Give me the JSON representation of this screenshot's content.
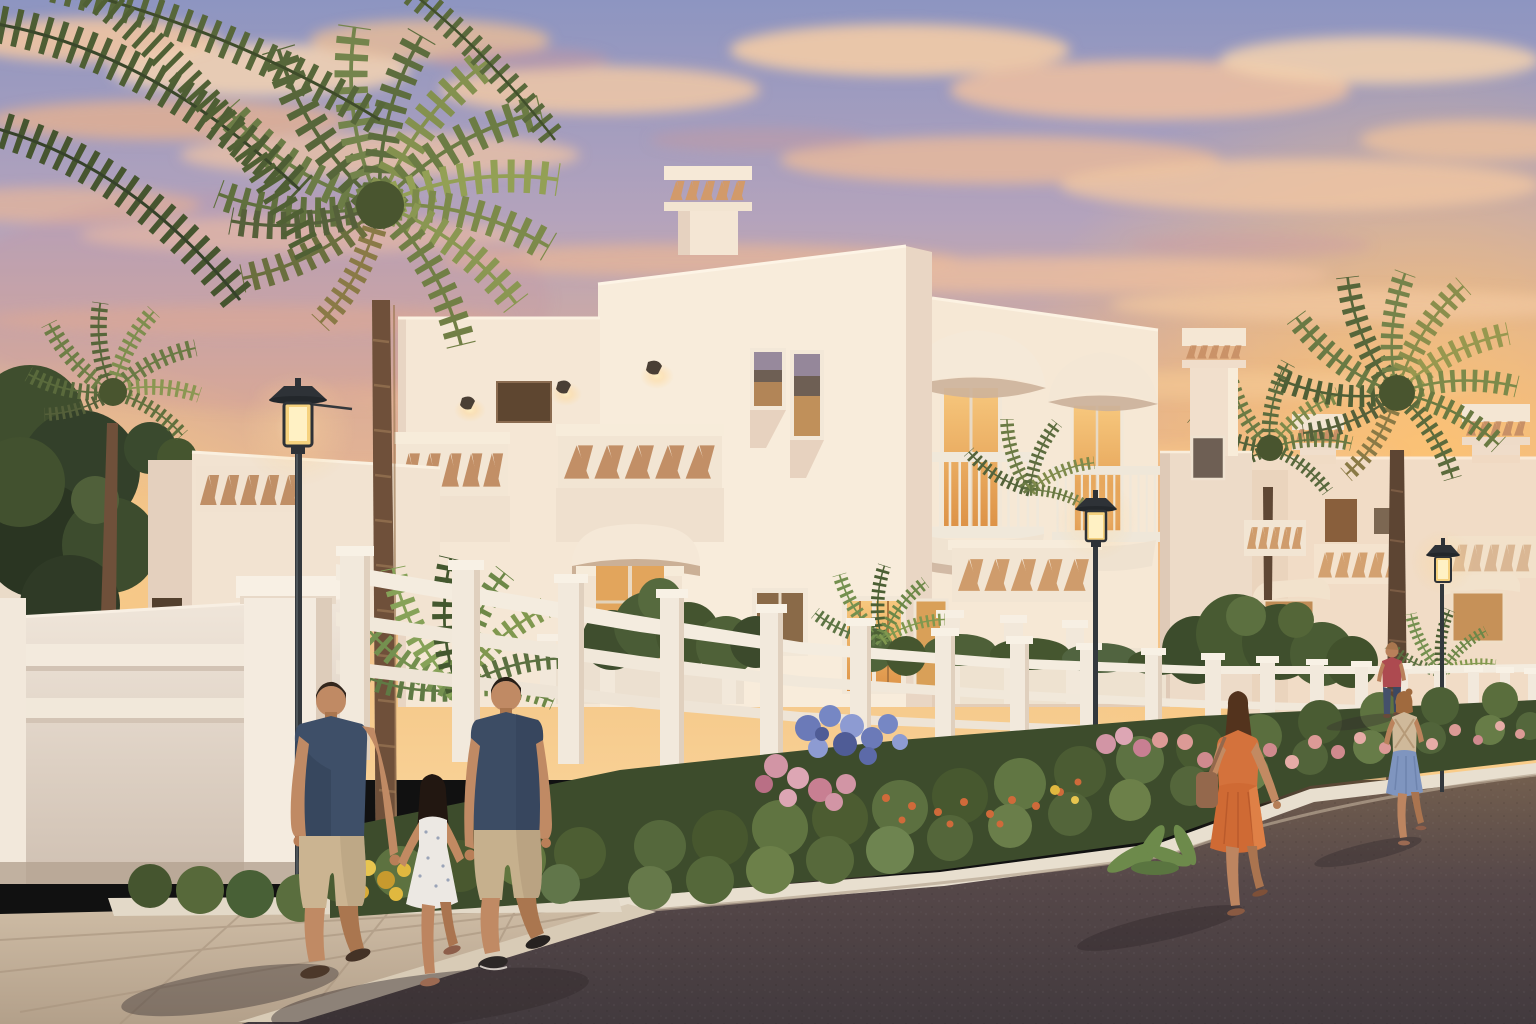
{
  "scene": {
    "type": "architectural-render",
    "description": "Sunset view of a whitewashed Mediterranean-style villa community: two-storey houses with decorative lattice chimneys, perforated parapets and domed balconies, palm trees, flowering street gardens, glowing street lamps, and residents strolling along a curving asphalt lane",
    "time_of_day": "sunset",
    "weather": "scattered pink and gold clouds"
  },
  "palette": {
    "sky_top": "#8d95c1",
    "sky_mid": "#b4a3bc",
    "sky_warm": "#dcae96",
    "sky_gold": "#f6ca8c",
    "glow_orange": "#ffc470",
    "cloud_cream": "#f4d4b2",
    "cloud_peach": "#eec0a0",
    "cloud_mauve": "#c598a0",
    "wall_lit": "#f8ecdb",
    "wall_mid": "#f2e3d1",
    "wall_shade": "#e6d2c0",
    "wall_deep": "#d9c6b5",
    "trim_white": "#f7efe3",
    "hole_warm": "#c28f66",
    "lattice_glow": "#cf9c6c",
    "window_glow_hi": "#f7c87e",
    "window_glow_lo": "#dd9246",
    "window_dim": "#b9854e",
    "window_dark": "#6e5f54",
    "door_brown": "#7a5130",
    "foliage_dark": "#3f4e2e",
    "foliage_mid": "#55683c",
    "foliage_light": "#74884c",
    "foliage_bright": "#93a055",
    "trunk_brown": "#6f503a",
    "trunk_ring": "#8d6b4c",
    "fence_white": "#f2e9dc",
    "fence_shade": "#d8c7b5",
    "road_top": "#76614f",
    "road_mid": "#564849",
    "road_low": "#423a3e",
    "paver_light": "#cfbda6",
    "paver_dark": "#b3a08a",
    "curb_light": "#e8dfcf",
    "lamp_metal": "#2e3237",
    "lamp_glow_core": "#fff1c4",
    "lamp_glow_warm": "#f6d27e",
    "skin": "#c08a64",
    "skin_shade": "#aa764f",
    "shirt_navy": "#3e4f68",
    "shorts_khaki": "#cbb491",
    "dress_white": "#ece8e3",
    "dress_orange": "#d4723c",
    "bag_brown": "#94684c",
    "skirt_blue": "#7f95bf",
    "top_beige": "#cfb99a",
    "top_red": "#ad4a50",
    "jeans_blue": "#44506b",
    "hair_dark": "#33261c",
    "flower_blue": "#6b7ab8",
    "flower_blue_deep": "#4f5c96",
    "flower_pink": "#d295a5",
    "flower_salmon": "#dc9a96",
    "flower_yellow": "#e0b83f",
    "flower_orange": "#cf6a3a"
  },
  "inventory": {
    "buildings": [
      "main two-storey villa with lattice-capped chimneys, perforated triangle parapets, arched window hood and lit interiors",
      "attached wing with two domed balconies over lit french windows and zigzag porch parapet",
      "rear block with tall lattice chimney",
      "distant villas with lattice chimney caps, hooded windows and a brown entry door"
    ],
    "palm_trees": 6,
    "street_lamps": 3,
    "people": [
      {
        "id": "man-left",
        "description": "man in navy t-shirt and khaki shorts walking, sandals"
      },
      {
        "id": "girl-child",
        "description": "girl in white floral sundress held by the hand between two adults"
      },
      {
        "id": "man-right",
        "description": "man in navy t-shirt and khaki shorts holding the child's hand"
      },
      {
        "id": "woman-orange",
        "description": "woman in an orange knee-length dress with shoulder bag walking up the lane"
      },
      {
        "id": "woman-red",
        "description": "distant woman in red top and dark jeans"
      },
      {
        "id": "girl-blue",
        "description": "girl in beige crossed-strap top and blue skirt walking away"
      }
    ],
    "garden": [
      "blue hydrangeas",
      "pink hydrangeas",
      "salmon roses",
      "yellow flowers",
      "orange blossoms",
      "green shrubs",
      "fern palms"
    ],
    "ground": [
      "beige paver sidewalk",
      "white curbs",
      "dark asphalt lane with long evening shadows"
    ]
  }
}
